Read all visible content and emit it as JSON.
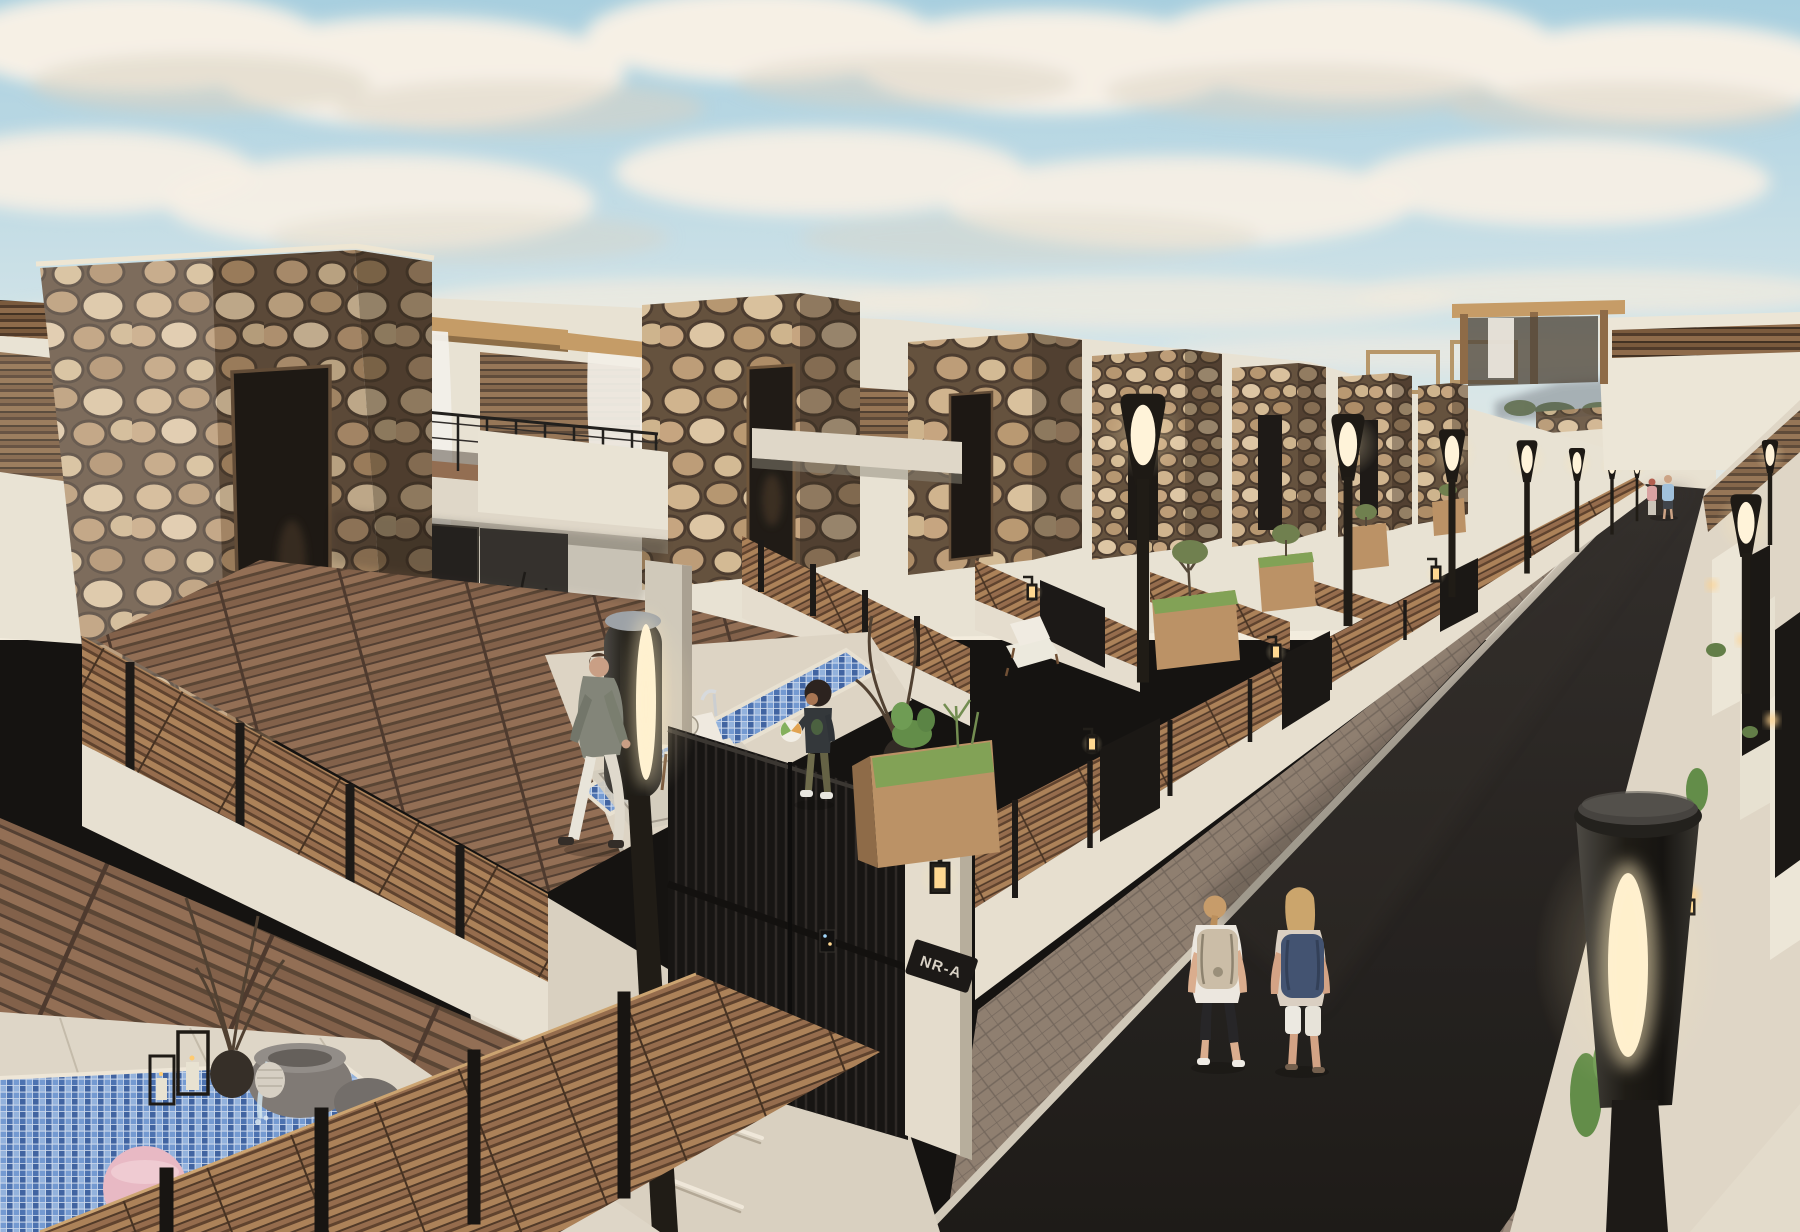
{
  "scene": {
    "title": "Modern villa street - 3D architectural render",
    "description": "Late-afternoon photoreal exterior render of a row of modern villas with river-stone entry towers, wooden slat fences, rooftop pergolas with sheer white curtains, blue mosaic plunge pools, a dark asphalt street lined with torch-style lamps and planters, and people walking.",
    "time_of_day": "late afternoon",
    "style": "photoreal 3D visualization"
  },
  "palette": {
    "sky_top": "#a5cfe0",
    "sky_mid": "#d3e5eb",
    "sky_horizon": "#f3edde",
    "cloud": "#f6f1e7",
    "cloud_shadow": "#d9d1c3",
    "mortar": "#5f4c39",
    "stone_light": "#d8c09c",
    "stone_mid": "#b4946e",
    "stucco": "#e9e3d5",
    "stucco_shade": "#c2b9a8",
    "wood": "#9a7350",
    "wood_dark": "#5c3f2a",
    "deck": "#8d6a50",
    "pool_grout": "#cfdcef",
    "pool_tile": "#466fb0",
    "road_light": "#2b2826",
    "road_dark": "#151311",
    "paver": "#8b7b6d",
    "curb": "#cfc7b8",
    "metal": "#17140f",
    "lamp_glow": "#fff6e0",
    "lantern_warm": "#ffd88f",
    "plant": "#5d8a44",
    "hill_haze": "#97a1a7"
  },
  "signage": {
    "gate_plaque": "NR-A"
  },
  "people": [
    {
      "id": "man-on-deck",
      "description": "Man in grey-green jacket and white trousers walking across the villa deck"
    },
    {
      "id": "child-with-ball",
      "description": "Child in dark top and olive cargo pants holding a white-green beach ball beside the pool"
    },
    {
      "id": "walker-left",
      "description": "Woman in white tee, black capris and beige backpack walking away on the road"
    },
    {
      "id": "walker-right",
      "description": "Woman in light floral top, white shorts and navy backpack walking beside her"
    },
    {
      "id": "distant-couple",
      "description": "Couple strolling at the far end of the street"
    }
  ],
  "objects": {
    "villas": "row of identical villas with stone-clad entry towers receding toward the vanishing point",
    "visible_stone_towers": 7,
    "street_lamps": "black torch-style lamps with glowing capsules on both sidewalks",
    "planters": "wooden planter boxes with cacti and grasses along the sidewalk",
    "pools": "blue mosaic plunge pools with chrome rails, pink ball floating in foreground pool",
    "gates": "black vertical-slat entry gates with keypad, wall lanterns and house plaque",
    "pergolas": "rooftop pergolas with sheer white curtains and warm sconces",
    "fountain": "grey stone bowl fountain spilling into the foreground pool",
    "furniture": "wooden lounge chairs with white cushions, outdoor rug, candle lanterns, ceramic vases with dry branches"
  }
}
